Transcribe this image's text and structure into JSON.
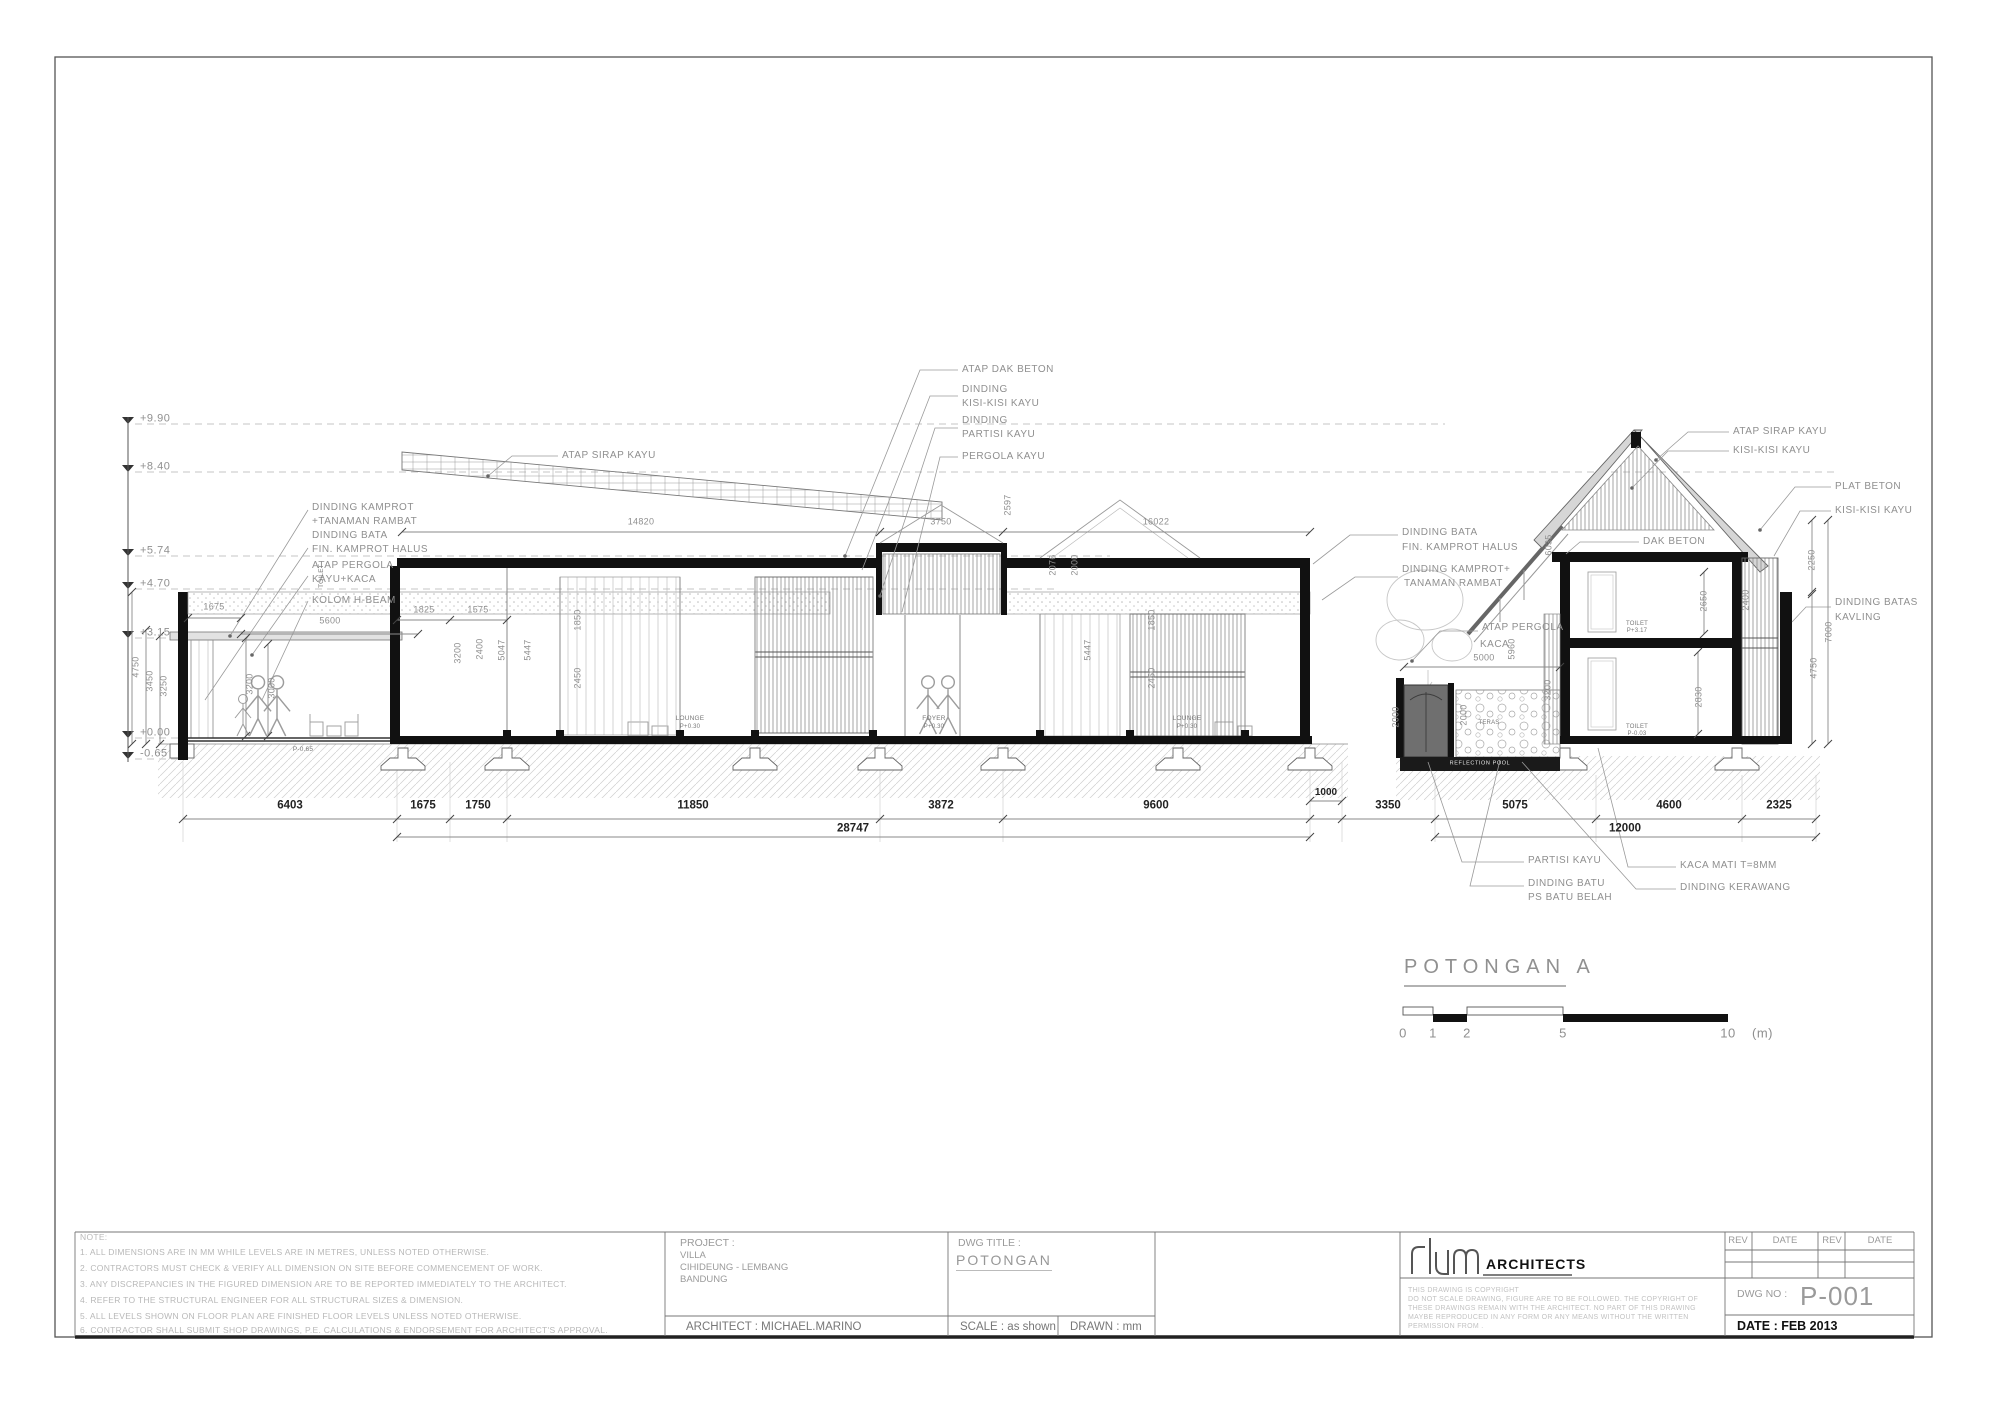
{
  "title_block": {
    "note_heading": "NOTE:",
    "notes": [
      "1.  ALL DIMENSIONS ARE IN MM WHILE LEVELS ARE IN METRES, UNLESS NOTED OTHERWISE.",
      "2.  CONTRACTORS MUST CHECK & VERIFY ALL DIMENSION ON SITE BEFORE COMMENCEMENT OF WORK.",
      "3.  ANY DISCREPANCIES IN THE FIGURED DIMENSION ARE TO BE REPORTED IMMEDIATELY TO THE ARCHITECT.",
      "4.  REFER TO THE STRUCTURAL ENGINEER FOR ALL STRUCTURAL SIZES & DIMENSION.",
      "5.  ALL LEVELS SHOWN ON FLOOR PLAN ARE FINISHED FLOOR LEVELS UNLESS NOTED OTHERWISE.",
      "6.  CONTRACTOR SHALL SUBMIT SHOP DRAWINGS, P.E. CALCULATIONS & ENDORSEMENT FOR ARCHITECT'S APPROVAL."
    ],
    "project_label": "PROJECT :",
    "project_lines": [
      "VILLA",
      "CIHIDEUNG - LEMBANG",
      "BANDUNG"
    ],
    "architect": "ARCHITECT : MICHAEL.MARINO",
    "dwg_title_label": "DWG TITLE :",
    "dwg_title": "POTONGAN",
    "scale": "SCALE : as shown",
    "drawn": "DRAWN : mm",
    "firm": "ARCHITECTS",
    "copyright_lines": [
      "THIS  DRAWING  IS  COPYRIGHT",
      "DO NOT SCALE DRAWING, FIGURE ARE TO BE FOLLOWED. THE COPYRIGHT OF",
      "THESE DRAWINGS REMAIN WITH THE ARCHITECT. NO PART OF THIS DRAWING",
      "MAYBE REPRODUCED IN ANY FORM OR ANY MEANS WITHOUT THE WRITTEN",
      "PERMISSION FROM ."
    ],
    "rev_headers": [
      "REV",
      "DATE",
      "REV",
      "DATE"
    ],
    "dwg_no_label": "DWG NO :",
    "dwg_no": "P-001",
    "date": "DATE : FEB 2013"
  },
  "drawing": {
    "section_title": "POTONGAN A",
    "scalebar_unit": "(m)",
    "texts": [
      {
        "t": "+9.90",
        "x": 140,
        "y": 419,
        "fs": 11,
        "a": "s",
        "c": "g",
        "n": "level-990"
      },
      {
        "t": "+8.40",
        "x": 140,
        "y": 467,
        "fs": 11,
        "a": "s",
        "c": "g",
        "n": "level-840"
      },
      {
        "t": "+5.74",
        "x": 140,
        "y": 551,
        "fs": 11,
        "a": "s",
        "c": "g",
        "n": "level-574"
      },
      {
        "t": "+4.70",
        "x": 140,
        "y": 584,
        "fs": 11,
        "a": "s",
        "c": "g",
        "n": "level-470"
      },
      {
        "t": "+3.15",
        "x": 140,
        "y": 633,
        "fs": 11,
        "a": "s",
        "c": "g",
        "n": "level-315"
      },
      {
        "t": "+0.00",
        "x": 140,
        "y": 733,
        "fs": 11,
        "a": "s",
        "c": "g",
        "n": "level-000"
      },
      {
        "t": "-0.65",
        "x": 140,
        "y": 754,
        "fs": 11,
        "a": "s",
        "c": "g",
        "n": "level-m065"
      },
      {
        "t": "DINDING KAMPROT",
        "x": 312,
        "y": 508,
        "fs": 10,
        "a": "s",
        "c": "g"
      },
      {
        "t": "+TANAMAN RAMBAT",
        "x": 312,
        "y": 522,
        "fs": 10,
        "a": "s",
        "c": "g"
      },
      {
        "t": "DINDING BATA",
        "x": 312,
        "y": 536,
        "fs": 10,
        "a": "s",
        "c": "g"
      },
      {
        "t": "FIN. KAMPROT HALUS",
        "x": 312,
        "y": 550,
        "fs": 10,
        "a": "s",
        "c": "g"
      },
      {
        "t": "ATAP PERGOLA",
        "x": 312,
        "y": 566,
        "fs": 10,
        "a": "s",
        "c": "g"
      },
      {
        "t": "KAYU+KACA",
        "x": 312,
        "y": 580,
        "fs": 10,
        "a": "s",
        "c": "g"
      },
      {
        "t": "KOLOM H-BEAM",
        "x": 312,
        "y": 601,
        "fs": 10,
        "a": "s",
        "c": "g"
      },
      {
        "t": "ATAP SIRAP KAYU",
        "x": 562,
        "y": 456,
        "fs": 10,
        "a": "s",
        "c": "g"
      },
      {
        "t": "ATAP DAK BETON",
        "x": 962,
        "y": 370,
        "fs": 10,
        "a": "s",
        "c": "g"
      },
      {
        "t": "DINDING",
        "x": 962,
        "y": 390,
        "fs": 10,
        "a": "s",
        "c": "g"
      },
      {
        "t": "KISI-KISI KAYU",
        "x": 962,
        "y": 404,
        "fs": 10,
        "a": "s",
        "c": "g"
      },
      {
        "t": "DINDING",
        "x": 962,
        "y": 421,
        "fs": 10,
        "a": "s",
        "c": "g"
      },
      {
        "t": "PARTISI KAYU",
        "x": 962,
        "y": 435,
        "fs": 10,
        "a": "s",
        "c": "g"
      },
      {
        "t": "PERGOLA KAYU",
        "x": 962,
        "y": 457,
        "fs": 10,
        "a": "s",
        "c": "g"
      },
      {
        "t": "ATAP SIRAP KAYU",
        "x": 1733,
        "y": 432,
        "fs": 10,
        "a": "s",
        "c": "g"
      },
      {
        "t": "KISI-KISI KAYU",
        "x": 1733,
        "y": 451,
        "fs": 10,
        "a": "s",
        "c": "g"
      },
      {
        "t": "PLAT BETON",
        "x": 1835,
        "y": 487,
        "fs": 10,
        "a": "s",
        "c": "g"
      },
      {
        "t": "KISI-KISI KAYU",
        "x": 1835,
        "y": 511,
        "fs": 10,
        "a": "s",
        "c": "g"
      },
      {
        "t": "DAK BETON",
        "x": 1643,
        "y": 542,
        "fs": 10,
        "a": "s",
        "c": "g"
      },
      {
        "t": "DINDING BATAS",
        "x": 1835,
        "y": 603,
        "fs": 10,
        "a": "s",
        "c": "g"
      },
      {
        "t": "KAVLING",
        "x": 1835,
        "y": 618,
        "fs": 10,
        "a": "s",
        "c": "g"
      },
      {
        "t": "DINDING BATA",
        "x": 1402,
        "y": 533,
        "fs": 10,
        "a": "s",
        "c": "g"
      },
      {
        "t": "FIN. KAMPROT HALUS",
        "x": 1402,
        "y": 548,
        "fs": 10,
        "a": "s",
        "c": "g"
      },
      {
        "t": "DINDING KAMPROT+",
        "x": 1402,
        "y": 570,
        "fs": 10,
        "a": "s",
        "c": "g"
      },
      {
        "t": "TANAMAN RAMBAT",
        "x": 1404,
        "y": 584,
        "fs": 10,
        "a": "s",
        "c": "g"
      },
      {
        "t": "ATAP PERGOLA",
        "x": 1482,
        "y": 628,
        "fs": 10,
        "a": "s",
        "c": "g"
      },
      {
        "t": "KACA",
        "x": 1480,
        "y": 645,
        "fs": 10,
        "a": "s",
        "c": "g"
      },
      {
        "t": "PARTISI KAYU",
        "x": 1528,
        "y": 861,
        "fs": 10,
        "a": "s",
        "c": "g"
      },
      {
        "t": "DINDING BATU",
        "x": 1528,
        "y": 884,
        "fs": 10,
        "a": "s",
        "c": "g"
      },
      {
        "t": "PS BATU BELAH",
        "x": 1528,
        "y": 898,
        "fs": 10,
        "a": "s",
        "c": "g"
      },
      {
        "t": "KACA MATI T=8MM",
        "x": 1680,
        "y": 866,
        "fs": 10,
        "a": "s",
        "c": "g"
      },
      {
        "t": "DINDING KERAWANG",
        "x": 1680,
        "y": 888,
        "fs": 10,
        "a": "s",
        "c": "g"
      },
      {
        "t": "6403",
        "x": 290,
        "y": 806,
        "fs": 11.5,
        "c": "d"
      },
      {
        "t": "1675",
        "x": 423,
        "y": 806,
        "fs": 11.5,
        "c": "d"
      },
      {
        "t": "1750",
        "x": 478,
        "y": 806,
        "fs": 11.5,
        "c": "d"
      },
      {
        "t": "11850",
        "x": 693,
        "y": 806,
        "fs": 11.5,
        "c": "d"
      },
      {
        "t": "3872",
        "x": 941,
        "y": 806,
        "fs": 11.5,
        "c": "d"
      },
      {
        "t": "9600",
        "x": 1156,
        "y": 806,
        "fs": 11.5,
        "c": "d"
      },
      {
        "t": "1000",
        "x": 1326,
        "y": 793,
        "fs": 10,
        "c": "d"
      },
      {
        "t": "3350",
        "x": 1388,
        "y": 806,
        "fs": 11.5,
        "c": "d"
      },
      {
        "t": "5075",
        "x": 1515,
        "y": 806,
        "fs": 11.5,
        "c": "d"
      },
      {
        "t": "4600",
        "x": 1669,
        "y": 806,
        "fs": 11.5,
        "c": "d"
      },
      {
        "t": "2325",
        "x": 1779,
        "y": 806,
        "fs": 11.5,
        "c": "d"
      },
      {
        "t": "28747",
        "x": 853,
        "y": 829,
        "fs": 11.5,
        "c": "d"
      },
      {
        "t": "12000",
        "x": 1625,
        "y": 829,
        "fs": 11.5,
        "c": "d"
      },
      {
        "t": "1675",
        "x": 214,
        "y": 607,
        "fs": 9,
        "c": "r"
      },
      {
        "t": "5600",
        "x": 330,
        "y": 621,
        "fs": 9,
        "c": "r"
      },
      {
        "t": "1825",
        "x": 424,
        "y": 610,
        "fs": 9,
        "c": "r"
      },
      {
        "t": "1575",
        "x": 478,
        "y": 610,
        "fs": 9,
        "c": "r"
      },
      {
        "t": "14820",
        "x": 641,
        "y": 522,
        "fs": 9,
        "c": "r"
      },
      {
        "t": "3750",
        "x": 941,
        "y": 522,
        "fs": 9,
        "c": "r"
      },
      {
        "t": "16022",
        "x": 1156,
        "y": 522,
        "fs": 9,
        "c": "r"
      },
      {
        "t": "5000",
        "x": 1484,
        "y": 658,
        "fs": 9,
        "c": "r"
      },
      {
        "t": "4750",
        "x": 136,
        "y": 667,
        "fs": 9,
        "r": -90,
        "c": "r"
      },
      {
        "t": "3450",
        "x": 150,
        "y": 681,
        "fs": 9,
        "r": -90,
        "c": "r"
      },
      {
        "t": "3250",
        "x": 164,
        "y": 686,
        "fs": 9,
        "r": -90,
        "c": "r"
      },
      {
        "t": "3200",
        "x": 250,
        "y": 684,
        "fs": 9,
        "r": -90,
        "c": "r"
      },
      {
        "t": "3000",
        "x": 272,
        "y": 688,
        "fs": 9,
        "r": -90,
        "c": "r"
      },
      {
        "t": "3200",
        "x": 458,
        "y": 653,
        "fs": 9,
        "r": -90,
        "c": "r"
      },
      {
        "t": "2400",
        "x": 480,
        "y": 649,
        "fs": 9,
        "r": -90,
        "c": "r"
      },
      {
        "t": "5047",
        "x": 502,
        "y": 650,
        "fs": 9,
        "r": -90,
        "c": "r"
      },
      {
        "t": "5447",
        "x": 528,
        "y": 650,
        "fs": 9,
        "r": -90,
        "c": "r"
      },
      {
        "t": "1850",
        "x": 578,
        "y": 620,
        "fs": 9,
        "r": -90,
        "c": "r"
      },
      {
        "t": "2450",
        "x": 578,
        "y": 678,
        "fs": 9,
        "r": -90,
        "c": "r"
      },
      {
        "t": "2597",
        "x": 1008,
        "y": 505,
        "fs": 9,
        "r": -90,
        "c": "r"
      },
      {
        "t": "5447",
        "x": 1088,
        "y": 650,
        "fs": 9,
        "r": -90,
        "c": "r"
      },
      {
        "t": "1850",
        "x": 1152,
        "y": 620,
        "fs": 9,
        "r": -90,
        "c": "r"
      },
      {
        "t": "2450",
        "x": 1152,
        "y": 678,
        "fs": 9,
        "r": -90,
        "c": "r"
      },
      {
        "t": "2076",
        "x": 1053,
        "y": 565,
        "fs": 9,
        "r": -90,
        "c": "r"
      },
      {
        "t": "2000",
        "x": 1075,
        "y": 565,
        "fs": 9,
        "r": -90,
        "c": "r"
      },
      {
        "t": "6035",
        "x": 1549,
        "y": 545,
        "fs": 9,
        "r": -90,
        "c": "r"
      },
      {
        "t": "5960",
        "x": 1512,
        "y": 649,
        "fs": 9,
        "r": -90,
        "c": "r"
      },
      {
        "t": "3200",
        "x": 1548,
        "y": 690,
        "fs": 9,
        "r": -90,
        "c": "r"
      },
      {
        "t": "2000",
        "x": 1396,
        "y": 717,
        "fs": 9,
        "r": -90,
        "c": "r"
      },
      {
        "t": "2000",
        "x": 1464,
        "y": 715,
        "fs": 9,
        "r": -90,
        "c": "r"
      },
      {
        "t": "2400",
        "x": 1746,
        "y": 600,
        "fs": 9,
        "r": -90,
        "c": "r"
      },
      {
        "t": "2650",
        "x": 1704,
        "y": 601,
        "fs": 9,
        "r": -90,
        "c": "r"
      },
      {
        "t": "2830",
        "x": 1699,
        "y": 697,
        "fs": 9,
        "r": -90,
        "c": "r"
      },
      {
        "t": "2250",
        "x": 1812,
        "y": 560,
        "fs": 9,
        "r": -90,
        "c": "r"
      },
      {
        "t": "7000",
        "x": 1829,
        "y": 632,
        "fs": 9,
        "r": -90,
        "c": "r"
      },
      {
        "t": "4750",
        "x": 1814,
        "y": 668,
        "fs": 9,
        "r": -90,
        "c": "r"
      },
      {
        "t": "TOILET",
        "x": 322,
        "y": 576,
        "fs": 6.5,
        "r": -90,
        "c": "t"
      },
      {
        "t": "LOUNGE",
        "x": 690,
        "y": 719,
        "fs": 6.5,
        "c": "t"
      },
      {
        "t": "P+0.30",
        "x": 690,
        "y": 727,
        "fs": 6,
        "c": "t"
      },
      {
        "t": "FOYER",
        "x": 934,
        "y": 719,
        "fs": 6.5,
        "c": "t"
      },
      {
        "t": "P+0.30",
        "x": 934,
        "y": 727,
        "fs": 6,
        "c": "t"
      },
      {
        "t": "LOUNGE",
        "x": 1187,
        "y": 719,
        "fs": 6.5,
        "c": "t"
      },
      {
        "t": "P+0.30",
        "x": 1187,
        "y": 727,
        "fs": 6,
        "c": "t"
      },
      {
        "t": "TOILET",
        "x": 1637,
        "y": 624,
        "fs": 6,
        "c": "t"
      },
      {
        "t": "P+3.17",
        "x": 1637,
        "y": 631,
        "fs": 6,
        "c": "t"
      },
      {
        "t": "TOILET",
        "x": 1637,
        "y": 727,
        "fs": 6,
        "c": "t"
      },
      {
        "t": "P-0.03",
        "x": 1637,
        "y": 734,
        "fs": 6,
        "c": "t"
      },
      {
        "t": "TERAS",
        "x": 1489,
        "y": 723,
        "fs": 6,
        "c": "t"
      },
      {
        "t": "REFLECTION POOL",
        "x": 1480,
        "y": 764,
        "fs": 5.5,
        "c": "w"
      },
      {
        "t": "P-0.65",
        "x": 303,
        "y": 750,
        "fs": 6.5,
        "c": "t"
      },
      {
        "t": "POTONGAN A",
        "x": 1404,
        "y": 967,
        "fs": 20,
        "a": "s",
        "c": "title",
        "n": "section-title"
      },
      {
        "t": "0",
        "x": 1403,
        "y": 1033,
        "fs": 13,
        "c": "g",
        "n": "scalebar-0"
      },
      {
        "t": "1",
        "x": 1433,
        "y": 1033,
        "fs": 13,
        "c": "g",
        "n": "scalebar-1"
      },
      {
        "t": "2",
        "x": 1467,
        "y": 1033,
        "fs": 13,
        "c": "g",
        "n": "scalebar-2"
      },
      {
        "t": "5",
        "x": 1563,
        "y": 1033,
        "fs": 13,
        "c": "g",
        "n": "scalebar-5"
      },
      {
        "t": "10",
        "x": 1728,
        "y": 1033,
        "fs": 13,
        "c": "g",
        "n": "scalebar-10"
      },
      {
        "t": "(m)",
        "x": 1752,
        "y": 1033,
        "fs": 13,
        "a": "s",
        "c": "g",
        "n": "scalebar-unit"
      }
    ]
  }
}
